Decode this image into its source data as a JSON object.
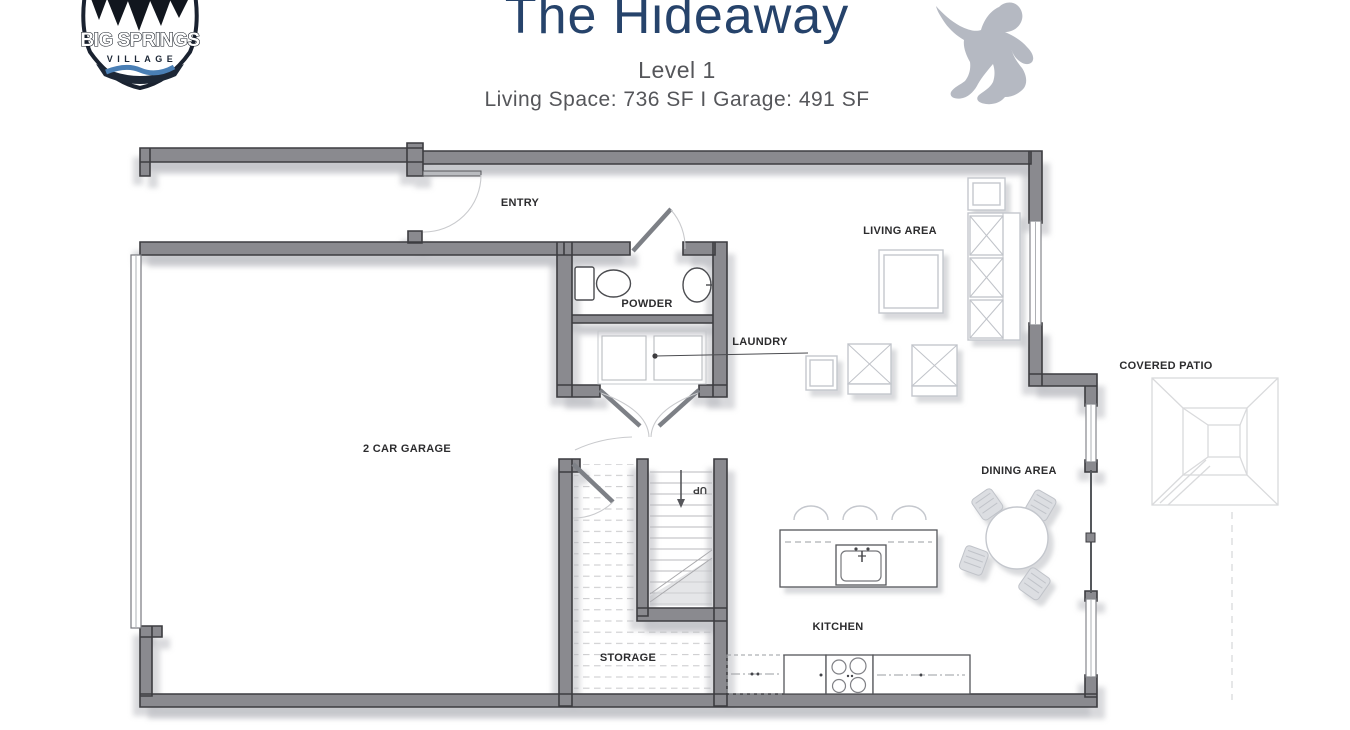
{
  "header": {
    "title": "The Hideaway",
    "level": "Level 1",
    "stats": "Living Space: 736 SF I Garage: 491 SF",
    "logo": {
      "line1": "BIG SPRINGS",
      "line2": "VILLAGE"
    }
  },
  "plan": {
    "labels": {
      "entry": "ENTRY",
      "powder": "POWDER",
      "laundry": "LAUNDRY",
      "living": "LIVING AREA",
      "garage": "2 CAR GARAGE",
      "dining": "DINING AREA",
      "patio": "COVERED PATIO",
      "kitchen": "KITCHEN",
      "storage": "STORAGE",
      "up": "UP"
    },
    "colors": {
      "wall": "#8a8a8f",
      "wall_outline": "#3c3c40",
      "wall_shadow": "#b2b4ba",
      "fixture": "#4b4c50",
      "ghost_furniture": "#c4c7cd",
      "patio_line": "#d9dadc",
      "title": "#26436b",
      "subtitle": "#55565a",
      "label": "#2c2c2e",
      "logo_dark": "#1d2736",
      "river_blue": "#4a7fb5",
      "sasquatch": "#b5b9c2"
    }
  }
}
